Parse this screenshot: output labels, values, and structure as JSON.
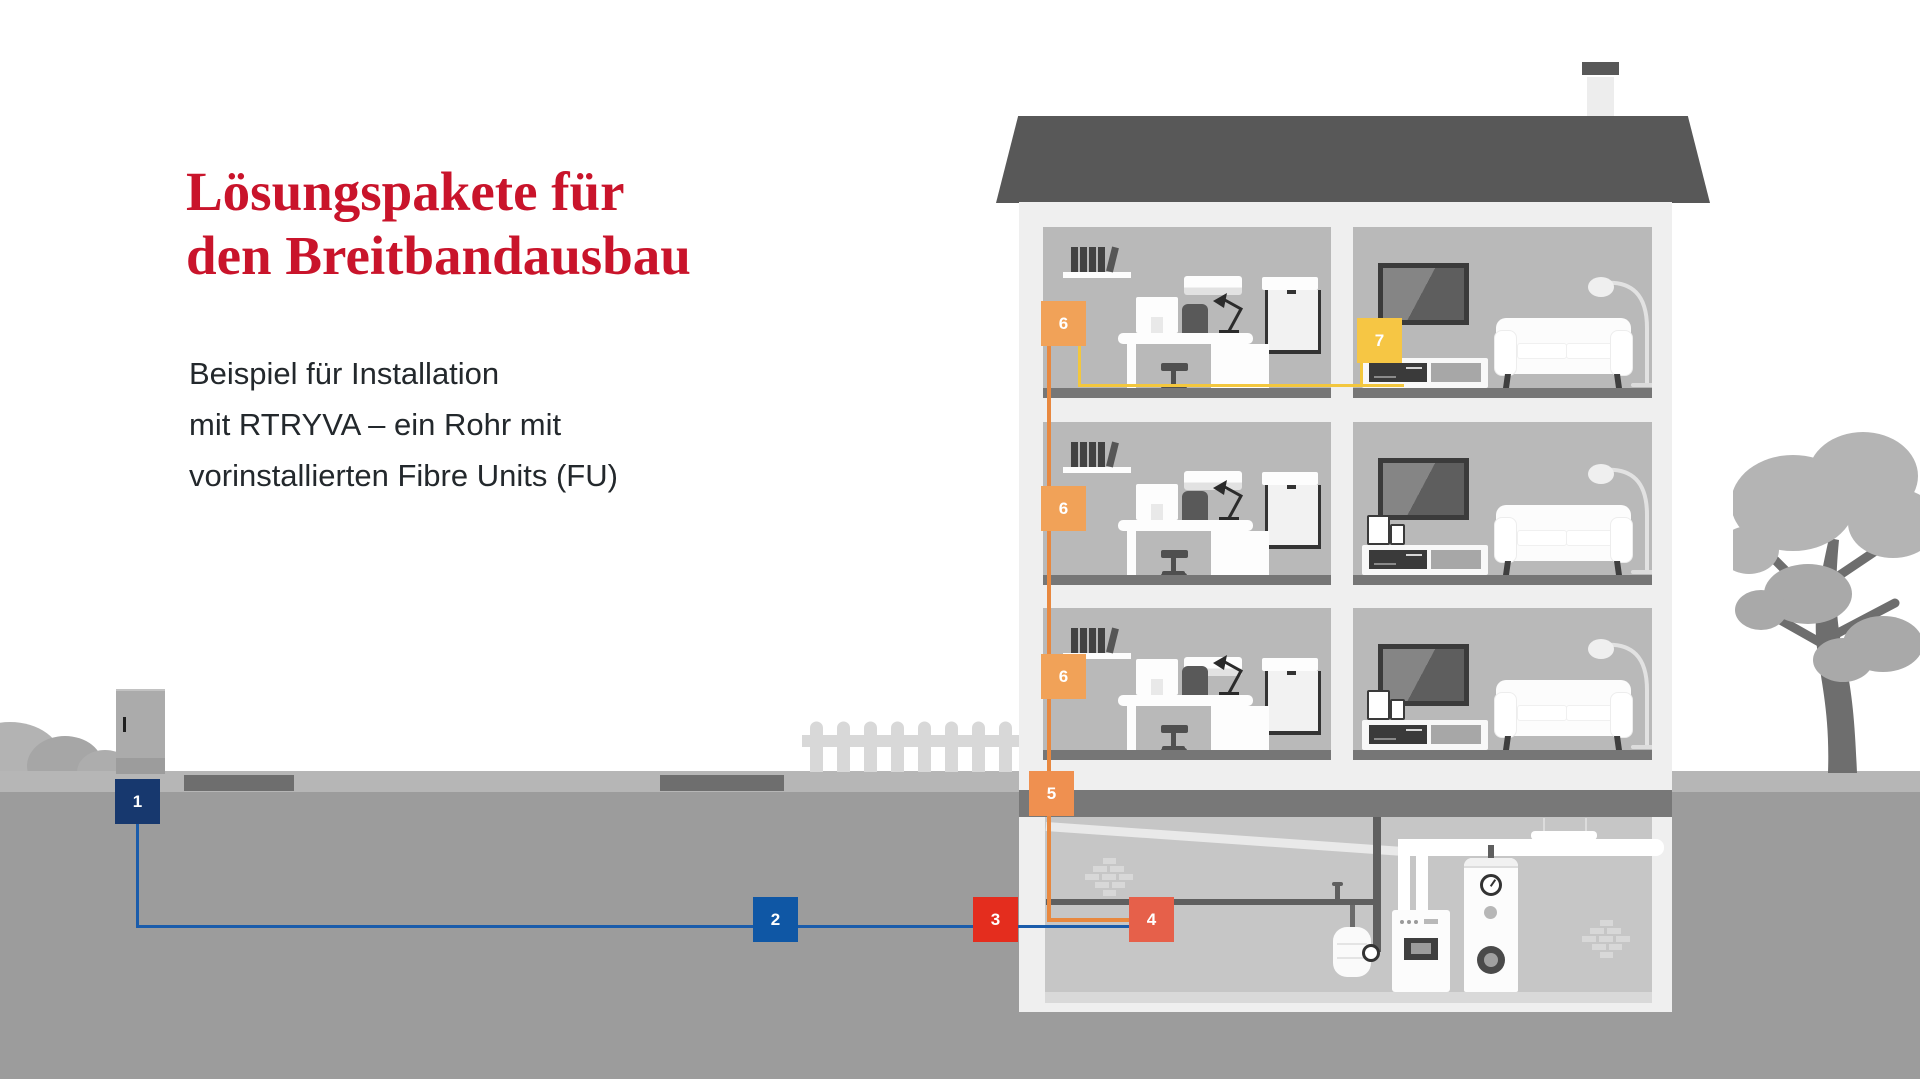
{
  "heading": {
    "title_line1": "Lösungspakete für",
    "title_line2": "den Breitbandausbau",
    "title_color": "#c9142b",
    "subtitle_line1": "Beispiel für Installation",
    "subtitle_line2": "mit RTRYVA – ein Rohr mit",
    "subtitle_line3": "vorinstallierten Fibre Units (FU)"
  },
  "markers": {
    "m1": {
      "label": "1",
      "color": "#17386e"
    },
    "m2": {
      "label": "2",
      "color": "#0f57a5"
    },
    "m3": {
      "label": "3",
      "color": "#e42d1e"
    },
    "m4": {
      "label": "4",
      "color": "#e6604a"
    },
    "m5": {
      "label": "5",
      "color": "#ef9050"
    },
    "m6a": {
      "label": "6",
      "color": "#f1a258"
    },
    "m6b": {
      "label": "6",
      "color": "#f1a258"
    },
    "m6c": {
      "label": "6",
      "color": "#f1a258"
    },
    "m7": {
      "label": "7",
      "color": "#f6c644"
    }
  },
  "cables": {
    "underground_cable_color": "#1a5cab",
    "riser_cable_color": "#e8883f",
    "apartment_cable_color": "#f3c73e"
  },
  "scene": {
    "ground_color": "#9c9c9c",
    "sidewalk_color": "#b6b6b6",
    "house_wall_color": "#efefef",
    "room_color": "#b9b9b9",
    "roof_color": "#585858"
  }
}
